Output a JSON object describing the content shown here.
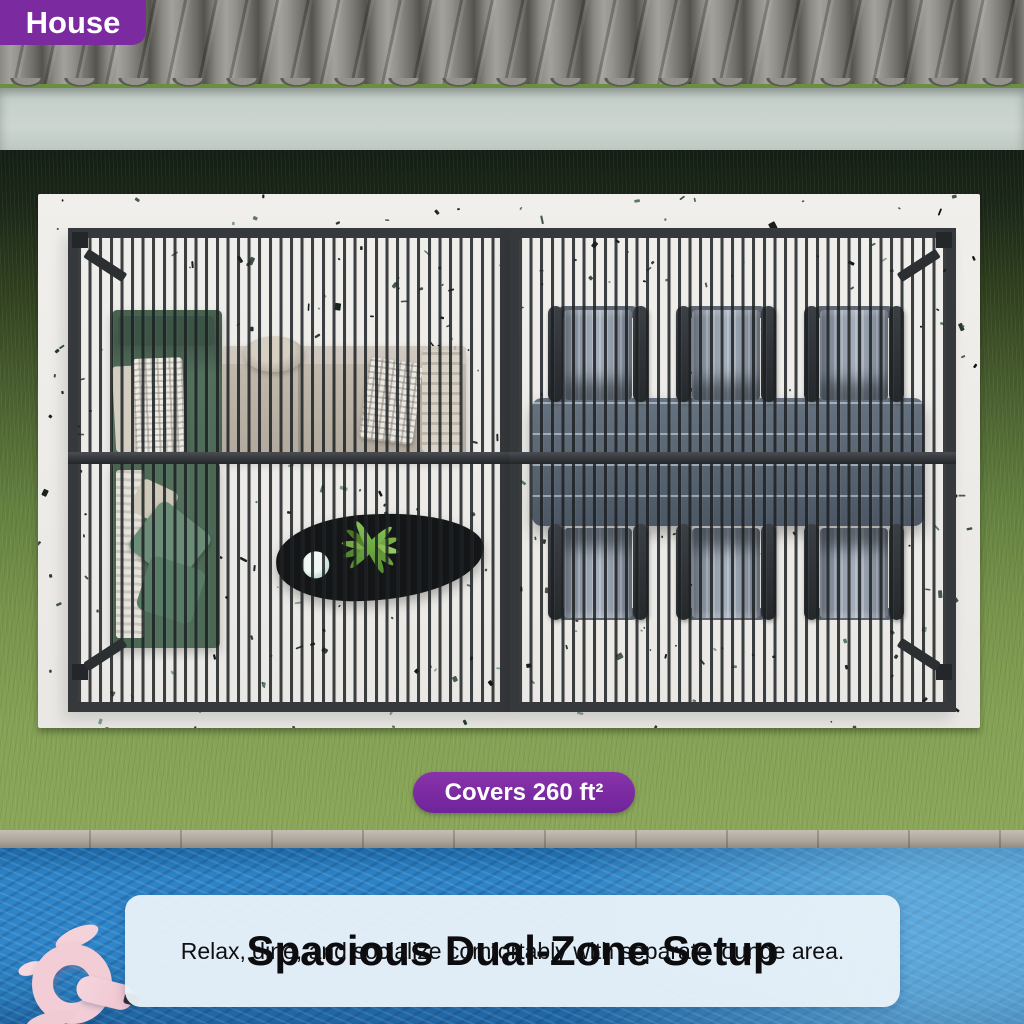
{
  "house_badge": {
    "label": "House"
  },
  "coverage_badge": {
    "label": "Covers 260 ft²"
  },
  "info_card": {
    "title": "Spacious Dual-Zone Setup",
    "subtitle": "Relax, dine, and socialize comfortably with separate lounge area."
  },
  "colors": {
    "accent_purple": "#7b2aa0",
    "pool_blue": "#2c81c5",
    "grass_green": "#7c984f",
    "pergola_frame": "#36393c",
    "terrazzo_base": "#eceae6",
    "card_background": "#e9f1f8",
    "float_pink": "#f2cdd6"
  }
}
